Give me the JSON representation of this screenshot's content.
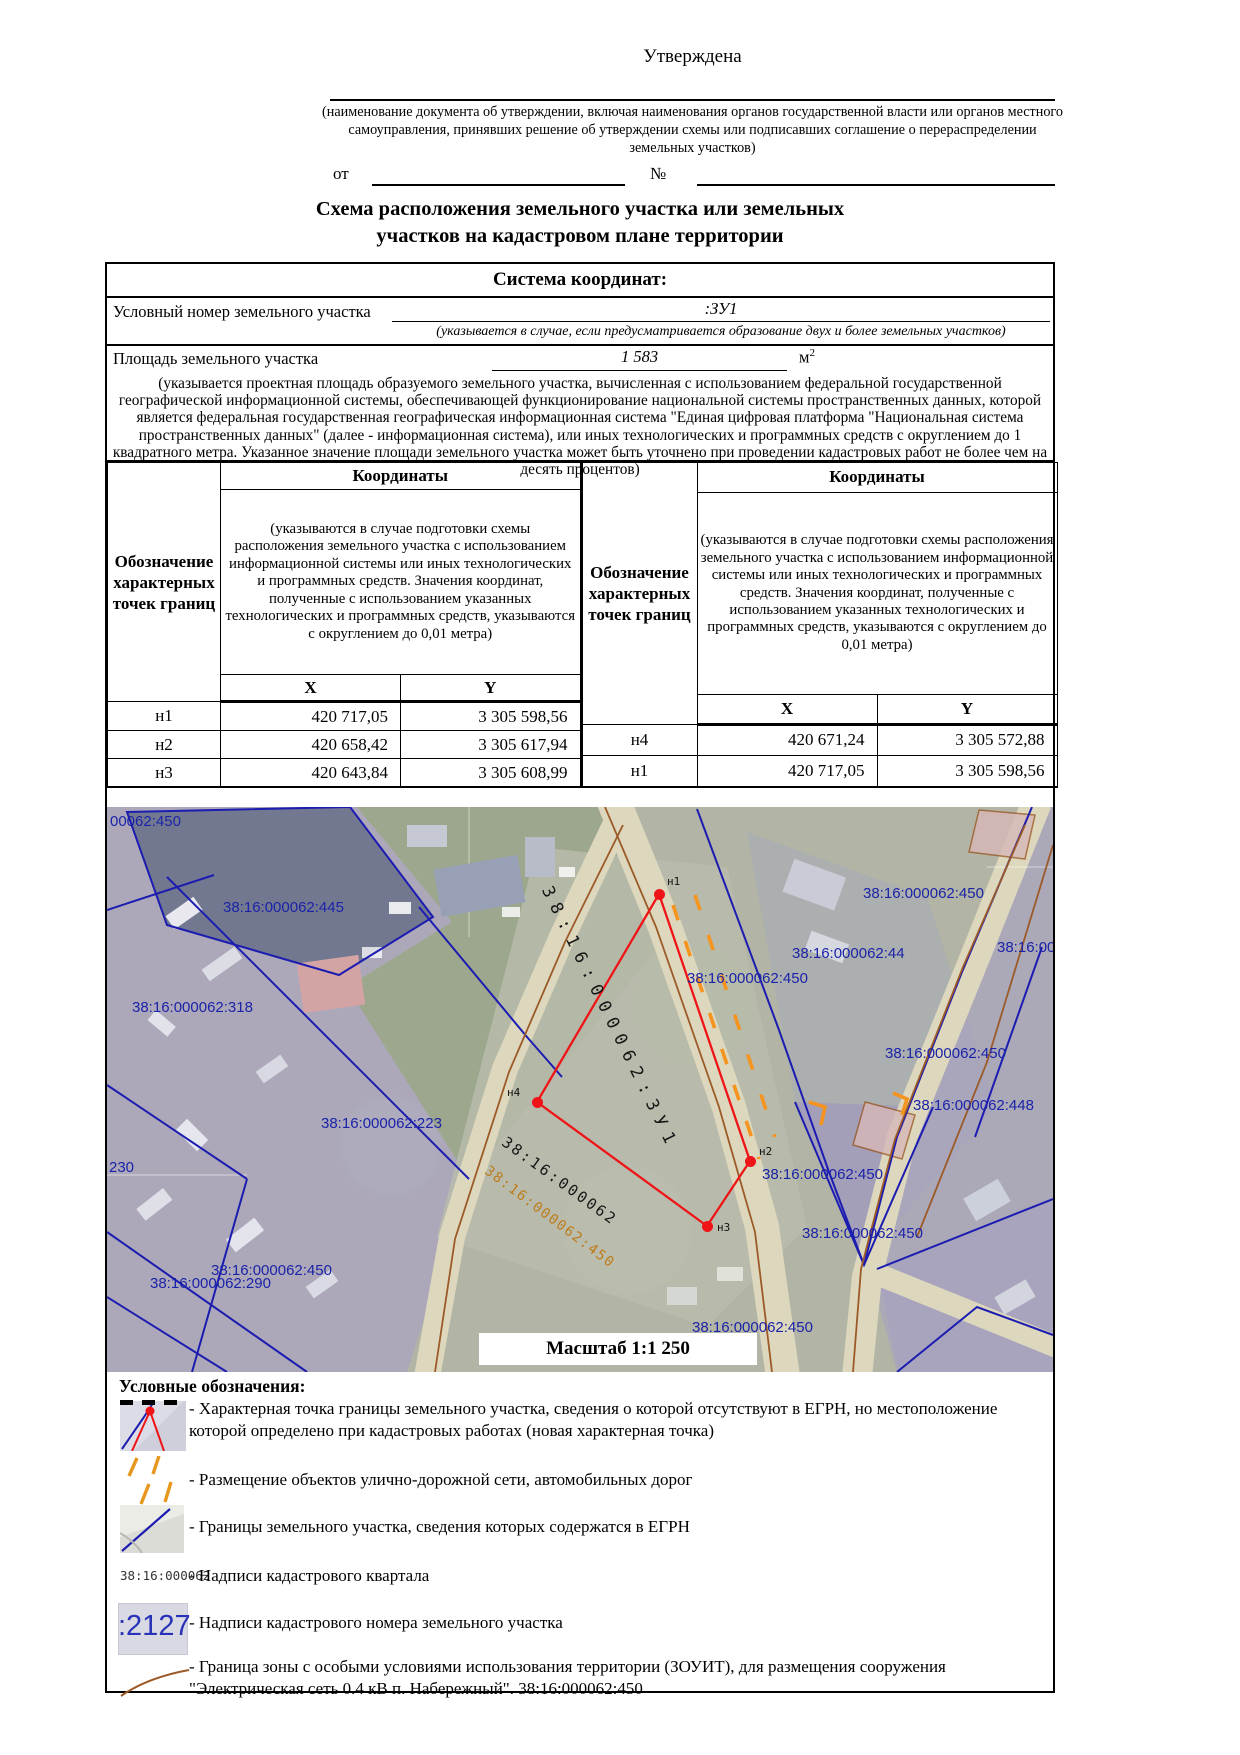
{
  "header": {
    "approved": "Утверждена",
    "approval_note": "(наименование документа об утверждении, включая наименования органов государственной власти или органов местного самоуправления, принявших решение об утверждении схемы или подписавших соглашение о перераспределении земельных участков)",
    "from_label": "от",
    "number_label": "№",
    "title_line1": "Схема расположения земельного участка или земельных",
    "title_line2": "участков на кадастровом плане территории"
  },
  "info": {
    "coord_system_title": "Система координат:",
    "cadastral_label": "Условный номер земельного участка",
    "cadastral_value": ":ЗУ1",
    "cadastral_note": "(указывается в случае, если предусматривается образование двух и более земельных участков)",
    "area_label": "Площадь земельного участка",
    "area_value": "1 583",
    "area_unit": "м",
    "area_unit_sup": "2",
    "area_note": "(указывается проектная площадь образуемого земельного участка, вычисленная с использованием федеральной государственной географической информационной системы, обеспечивающей функционирование национальной системы пространственных данных, которой является федеральная государственная географическая информационная система \"Единая цифровая платформа \"Национальная система пространственных данных\" (далее - информационная система), или иных технологических и программных средств с округлением до 1 квадратного метра. Указанное значение площади земельного участка может быть уточнено при проведении кадастровых работ не более чем на десять процентов)"
  },
  "coords_table": {
    "point_col": "Обозначение характерных точек границ",
    "coords_col": "Координаты",
    "note": "(указываются в случае подготовки схемы расположения земельного участка с использованием информационной системы или иных технологических и программных средств. Значения координат, полученные с использованием указанных технологических и программных средств, указываются с округлением до 0,01 метра)",
    "col_x": "X",
    "col_y": "Y",
    "left_rows": [
      [
        "н1",
        "420 717,05",
        "3 305 598,56"
      ],
      [
        "н2",
        "420 658,42",
        "3 305 617,94"
      ],
      [
        "н3",
        "420 643,84",
        "3 305 608,99"
      ]
    ],
    "right_rows": [
      [
        "н4",
        "420 671,24",
        "3 305 572,88"
      ],
      [
        "н1",
        "420 717,05",
        "3 305 598,56"
      ]
    ]
  },
  "map": {
    "scale_label": "Масштаб 1:1 250",
    "colors": {
      "parcel_line_blue": "#1c1cb0",
      "zouit_brown": "#9c5a28",
      "road_dash_orange": "#f5941e",
      "plot_red": "#ee1417",
      "label_blue": "#1b23a8"
    },
    "labels": [
      {
        "text": "00062:450",
        "x": 3,
        "y": 6,
        "kind": "blue"
      },
      {
        "text": "38:16:000062:445",
        "x": 116,
        "y": 92,
        "kind": "blue"
      },
      {
        "text": "38:16:000062:450",
        "x": 756,
        "y": 78,
        "kind": "blue"
      },
      {
        "text": "38:16:000062",
        "x": 890,
        "y": 132,
        "kind": "blue"
      },
      {
        "text": "38:16:000062:44",
        "x": 685,
        "y": 138,
        "kind": "blue"
      },
      {
        "text": "38:16:000062:450",
        "x": 580,
        "y": 163,
        "kind": "blue"
      },
      {
        "text": "38:16:000062:318",
        "x": 25,
        "y": 192,
        "kind": "blue"
      },
      {
        "text": "38:16:000062:223",
        "x": 214,
        "y": 308,
        "kind": "blue"
      },
      {
        "text": "230",
        "x": 2,
        "y": 352,
        "kind": "blue"
      },
      {
        "text": "38:16:000062:450",
        "x": 778,
        "y": 238,
        "kind": "blue"
      },
      {
        "text": "38:16:000062:448",
        "x": 806,
        "y": 290,
        "kind": "blue"
      },
      {
        "text": "38:16:000062:450",
        "x": 104,
        "y": 455,
        "kind": "blue"
      },
      {
        "text": "38:16:000062:290",
        "x": 43,
        "y": 468,
        "kind": "blue"
      },
      {
        "text": "38:16:000062:450",
        "x": 655,
        "y": 359,
        "kind": "blue"
      },
      {
        "text": "38:16:000062:450",
        "x": 695,
        "y": 418,
        "kind": "blue"
      },
      {
        "text": "38:16:000062:450",
        "x": 585,
        "y": 512,
        "kind": "blue"
      },
      {
        "text": "38:16:000062:ЗУ1",
        "x": 448,
        "y": 76,
        "kind": "black",
        "rot": 64,
        "fs": 17,
        "ls": 8
      },
      {
        "text": "38:16:000062",
        "x": 402,
        "y": 326,
        "kind": "black",
        "rot": 36,
        "fs": 15,
        "ls": 2.5
      },
      {
        "text": "38:16:000062:450",
        "x": 384,
        "y": 356,
        "kind": "orange",
        "rot": 37,
        "fs": 14,
        "ls": 1.5
      }
    ],
    "points": [
      {
        "name": "н1",
        "x": 552,
        "y": 87,
        "lx": 560,
        "ly": 68
      },
      {
        "name": "н2",
        "x": 643,
        "y": 354,
        "lx": 652,
        "ly": 338
      },
      {
        "name": "н3",
        "x": 600,
        "y": 419,
        "lx": 610,
        "ly": 414
      },
      {
        "name": "н4",
        "x": 430,
        "y": 295,
        "lx": 400,
        "ly": 279
      }
    ]
  },
  "legend": {
    "title": "Условные обозначения:",
    "item1": "- Характерная точка границы земельного участка, сведения о которой отсутствуют в ЕГРН, но местоположение которой определено при кадастровых работах (новая характерная точка)",
    "item2": "- Размещение объектов улично-дорожной сети, автомобильных дорог",
    "item3": "- Границы земельного участка, сведения которых содержатся в ЕГРН",
    "item4": "- Надписи кадастрового квартала",
    "item4_icon": "38:16:000062",
    "item5": "- Надписи кадастрового номера земельного участка",
    "item5_icon": ":2127",
    "item6": "- Граница зоны с особыми условиями использования территории (ЗОУИТ), для размещения сооружения \"Электрическая сеть 0.4 кВ п. Набережный\". 38:16:000062:450"
  }
}
